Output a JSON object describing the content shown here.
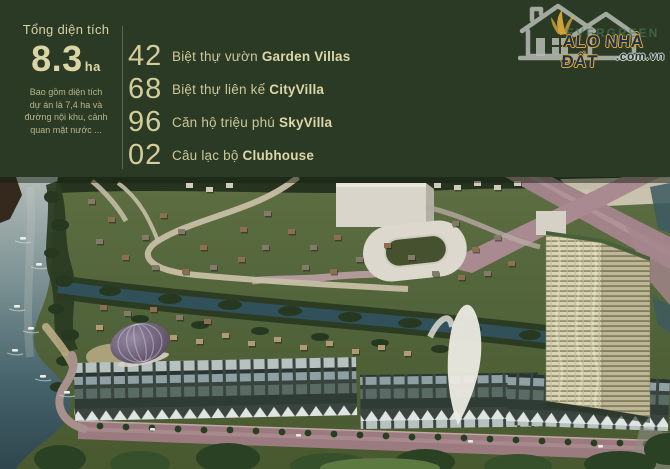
{
  "header": {
    "bg_color": "#2b3a24",
    "accent_text_color": "#d6d0a2",
    "total_area": {
      "label": "Tổng diện tích",
      "value": "8.3",
      "unit": "ha",
      "note_lines": [
        "Bao gồm diện tích",
        "dự án là 7,4 ha và",
        "đường nội khu, cảnh",
        "quan mặt nước ..."
      ]
    },
    "stats": [
      {
        "number": "42",
        "label": "Biệt thự vườn",
        "name": "Garden Villas"
      },
      {
        "number": "68",
        "label": "Biệt thự liên kế",
        "name": "CityVilla"
      },
      {
        "number": "96",
        "label": "Căn hộ triệu phú",
        "name": "SkyVilla"
      },
      {
        "number": "02",
        "label": "Câu lạc bộ",
        "name": "Clubhouse"
      }
    ]
  },
  "logo": {
    "title": "ALO NHÀ ĐẤT",
    "domain": ".com.vn",
    "watermark": "EVERGREEN",
    "title_color": "#1a2f5e",
    "outline_color": "#d8a92c",
    "house_color": "#b4b9b1"
  },
  "scene": {
    "palette": {
      "villa_colors": [
        "#857969",
        "#8f6e50",
        "#b39a74",
        "#d2cbbd"
      ],
      "tree_dark": "#26381f",
      "tree_street": "#26401f",
      "front_tree_colors": [
        "#2b4123",
        "#35502a",
        "#5c7a40"
      ]
    },
    "villas": [
      {
        "x": 88,
        "y": 22,
        "c": 0
      },
      {
        "x": 108,
        "y": 40,
        "c": 1
      },
      {
        "x": 96,
        "y": 62,
        "c": 0
      },
      {
        "x": 122,
        "y": 78,
        "c": 1
      },
      {
        "x": 142,
        "y": 58,
        "c": 0
      },
      {
        "x": 160,
        "y": 36,
        "c": 1
      },
      {
        "x": 178,
        "y": 52,
        "c": 0
      },
      {
        "x": 200,
        "y": 68,
        "c": 1
      },
      {
        "x": 152,
        "y": 88,
        "c": 0
      },
      {
        "x": 182,
        "y": 92,
        "c": 1
      },
      {
        "x": 210,
        "y": 88,
        "c": 0
      },
      {
        "x": 238,
        "y": 80,
        "c": 1
      },
      {
        "x": 262,
        "y": 68,
        "c": 0
      },
      {
        "x": 240,
        "y": 50,
        "c": 1
      },
      {
        "x": 264,
        "y": 34,
        "c": 0
      },
      {
        "x": 288,
        "y": 52,
        "c": 1
      },
      {
        "x": 310,
        "y": 68,
        "c": 0
      },
      {
        "x": 334,
        "y": 58,
        "c": 1
      },
      {
        "x": 302,
        "y": 88,
        "c": 0
      },
      {
        "x": 330,
        "y": 92,
        "c": 1
      },
      {
        "x": 356,
        "y": 80,
        "c": 0
      },
      {
        "x": 384,
        "y": 66,
        "c": 1
      },
      {
        "x": 408,
        "y": 78,
        "c": 0
      },
      {
        "x": 452,
        "y": 44,
        "c": 0
      },
      {
        "x": 472,
        "y": 70,
        "c": 1
      },
      {
        "x": 494,
        "y": 58,
        "c": 0
      },
      {
        "x": 508,
        "y": 84,
        "c": 1
      },
      {
        "x": 432,
        "y": 94,
        "c": 0
      },
      {
        "x": 458,
        "y": 98,
        "c": 1
      },
      {
        "x": 484,
        "y": 94,
        "c": 0
      },
      {
        "x": 100,
        "y": 128,
        "c": 1
      },
      {
        "x": 124,
        "y": 134,
        "c": 0
      },
      {
        "x": 150,
        "y": 130,
        "c": 1
      },
      {
        "x": 176,
        "y": 138,
        "c": 0
      },
      {
        "x": 204,
        "y": 142,
        "c": 1
      },
      {
        "x": 96,
        "y": 148,
        "c": 2
      },
      {
        "x": 120,
        "y": 156,
        "c": 2
      },
      {
        "x": 146,
        "y": 150,
        "c": 2
      },
      {
        "x": 170,
        "y": 158,
        "c": 2
      },
      {
        "x": 196,
        "y": 162,
        "c": 2
      },
      {
        "x": 222,
        "y": 156,
        "c": 2
      },
      {
        "x": 248,
        "y": 164,
        "c": 2
      },
      {
        "x": 274,
        "y": 160,
        "c": 2
      },
      {
        "x": 300,
        "y": 168,
        "c": 2
      },
      {
        "x": 326,
        "y": 164,
        "c": 2
      },
      {
        "x": 352,
        "y": 172,
        "c": 2
      },
      {
        "x": 378,
        "y": 168,
        "c": 2
      },
      {
        "x": 404,
        "y": 174,
        "c": 2
      },
      {
        "x": 186,
        "y": 6,
        "c": 3
      },
      {
        "x": 206,
        "y": 10,
        "c": 3
      },
      {
        "x": 226,
        "y": 6,
        "c": 3
      },
      {
        "x": 434,
        "y": 6,
        "c": 3
      },
      {
        "x": 454,
        "y": 8,
        "c": 3
      },
      {
        "x": 474,
        "y": 4,
        "c": 3
      },
      {
        "x": 494,
        "y": 8,
        "c": 3
      },
      {
        "x": 514,
        "y": 4,
        "c": 3
      }
    ],
    "canopies_back": [
      [
        52,
        20,
        8,
        6
      ],
      [
        60,
        48,
        9,
        6
      ],
      [
        52,
        76,
        8,
        5
      ],
      [
        64,
        104,
        9,
        6
      ],
      [
        56,
        132,
        8,
        5
      ],
      [
        70,
        158,
        9,
        6
      ],
      [
        64,
        184,
        8,
        5
      ],
      [
        58,
        210,
        8,
        5
      ],
      [
        110,
        114,
        11,
        5
      ],
      [
        170,
        122,
        12,
        5
      ],
      [
        230,
        128,
        12,
        5
      ],
      [
        290,
        134,
        12,
        5
      ],
      [
        350,
        140,
        12,
        5
      ],
      [
        410,
        146,
        12,
        5
      ],
      [
        470,
        152,
        12,
        5
      ],
      [
        530,
        158,
        11,
        5
      ],
      [
        140,
        142,
        9,
        4
      ],
      [
        200,
        148,
        9,
        4
      ],
      [
        260,
        154,
        9,
        4
      ],
      [
        320,
        160,
        9,
        4
      ],
      [
        380,
        166,
        9,
        4
      ],
      [
        440,
        172,
        9,
        4
      ]
    ],
    "canopies_front": [
      [
        60,
        282,
        26,
        14,
        0
      ],
      [
        140,
        287,
        30,
        13,
        1
      ],
      [
        228,
        281,
        32,
        15,
        0
      ],
      [
        330,
        289,
        40,
        13,
        1
      ],
      [
        425,
        285,
        30,
        13,
        0
      ],
      [
        518,
        289,
        34,
        12,
        1
      ],
      [
        620,
        287,
        36,
        13,
        0
      ],
      [
        380,
        291,
        60,
        10,
        2
      ],
      [
        668,
        272,
        24,
        16,
        0
      ]
    ],
    "street_trees": [
      [
        100,
        249
      ],
      [
        126,
        250
      ],
      [
        152,
        251
      ],
      [
        178,
        252
      ],
      [
        204,
        253
      ],
      [
        230,
        253
      ],
      [
        256,
        254
      ],
      [
        282,
        255
      ],
      [
        308,
        256
      ],
      [
        334,
        257
      ],
      [
        360,
        258
      ],
      [
        386,
        259
      ],
      [
        412,
        260
      ],
      [
        438,
        260
      ],
      [
        464,
        261
      ],
      [
        490,
        262
      ],
      [
        516,
        263
      ],
      [
        542,
        264
      ],
      [
        568,
        265
      ],
      [
        594,
        266
      ],
      [
        620,
        266
      ],
      [
        646,
        267
      ]
    ],
    "cars": [
      [
        150,
        251
      ],
      [
        296,
        257
      ],
      [
        468,
        263
      ],
      [
        598,
        268
      ]
    ],
    "boats": [
      [
        20,
        60
      ],
      [
        36,
        86
      ],
      [
        14,
        128
      ],
      [
        28,
        150
      ],
      [
        12,
        172
      ],
      [
        40,
        198
      ],
      [
        64,
        214
      ]
    ]
  }
}
